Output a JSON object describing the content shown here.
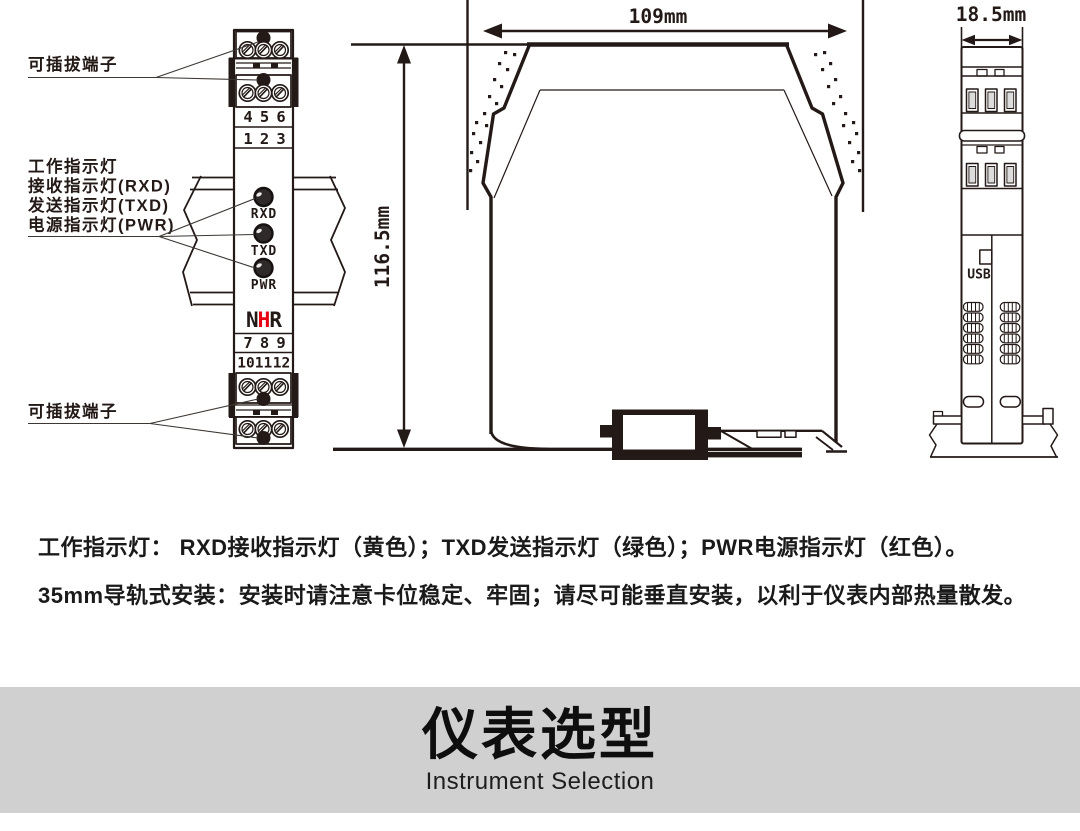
{
  "front_view": {
    "label_terminal_top": "可插拔端子",
    "label_terminal_bottom": "可插拔端子",
    "indicator_labels": [
      "工作指示灯",
      "接收指示灯(RXD)",
      "发送指示灯(TXD)",
      "电源指示灯(PWR)"
    ],
    "terminals_top_row1": [
      "4",
      "5",
      "6"
    ],
    "terminals_top_row2": [
      "1",
      "2",
      "3"
    ],
    "terminals_bottom_row1": [
      "7",
      "8",
      "9"
    ],
    "terminals_bottom_row2": [
      "10",
      "11",
      "12"
    ],
    "leds": [
      "RXD",
      "TXD",
      "PWR"
    ],
    "logo": [
      "N",
      "H",
      "R"
    ]
  },
  "side_view": {
    "width_dim": "109mm",
    "height_dim": "116.5mm"
  },
  "end_view": {
    "width_dim": "18.5mm",
    "usb_label": "USB"
  },
  "notes": [
    "工作指示灯： RXD接收指示灯（黄色）；TXD发送指示灯（绿色）；PWR电源指示灯（红色）。",
    "35mm导轨式安装：安装时请注意卡位稳定、牢固；请尽可能垂直安装，以利于仪表内部热量散发。"
  ],
  "banner": {
    "title": "仪表选型",
    "subtitle": "Instrument Selection"
  },
  "colors": {
    "ink": "#231916",
    "red": "#e60012",
    "banner_bg": "#d0d0d0"
  }
}
